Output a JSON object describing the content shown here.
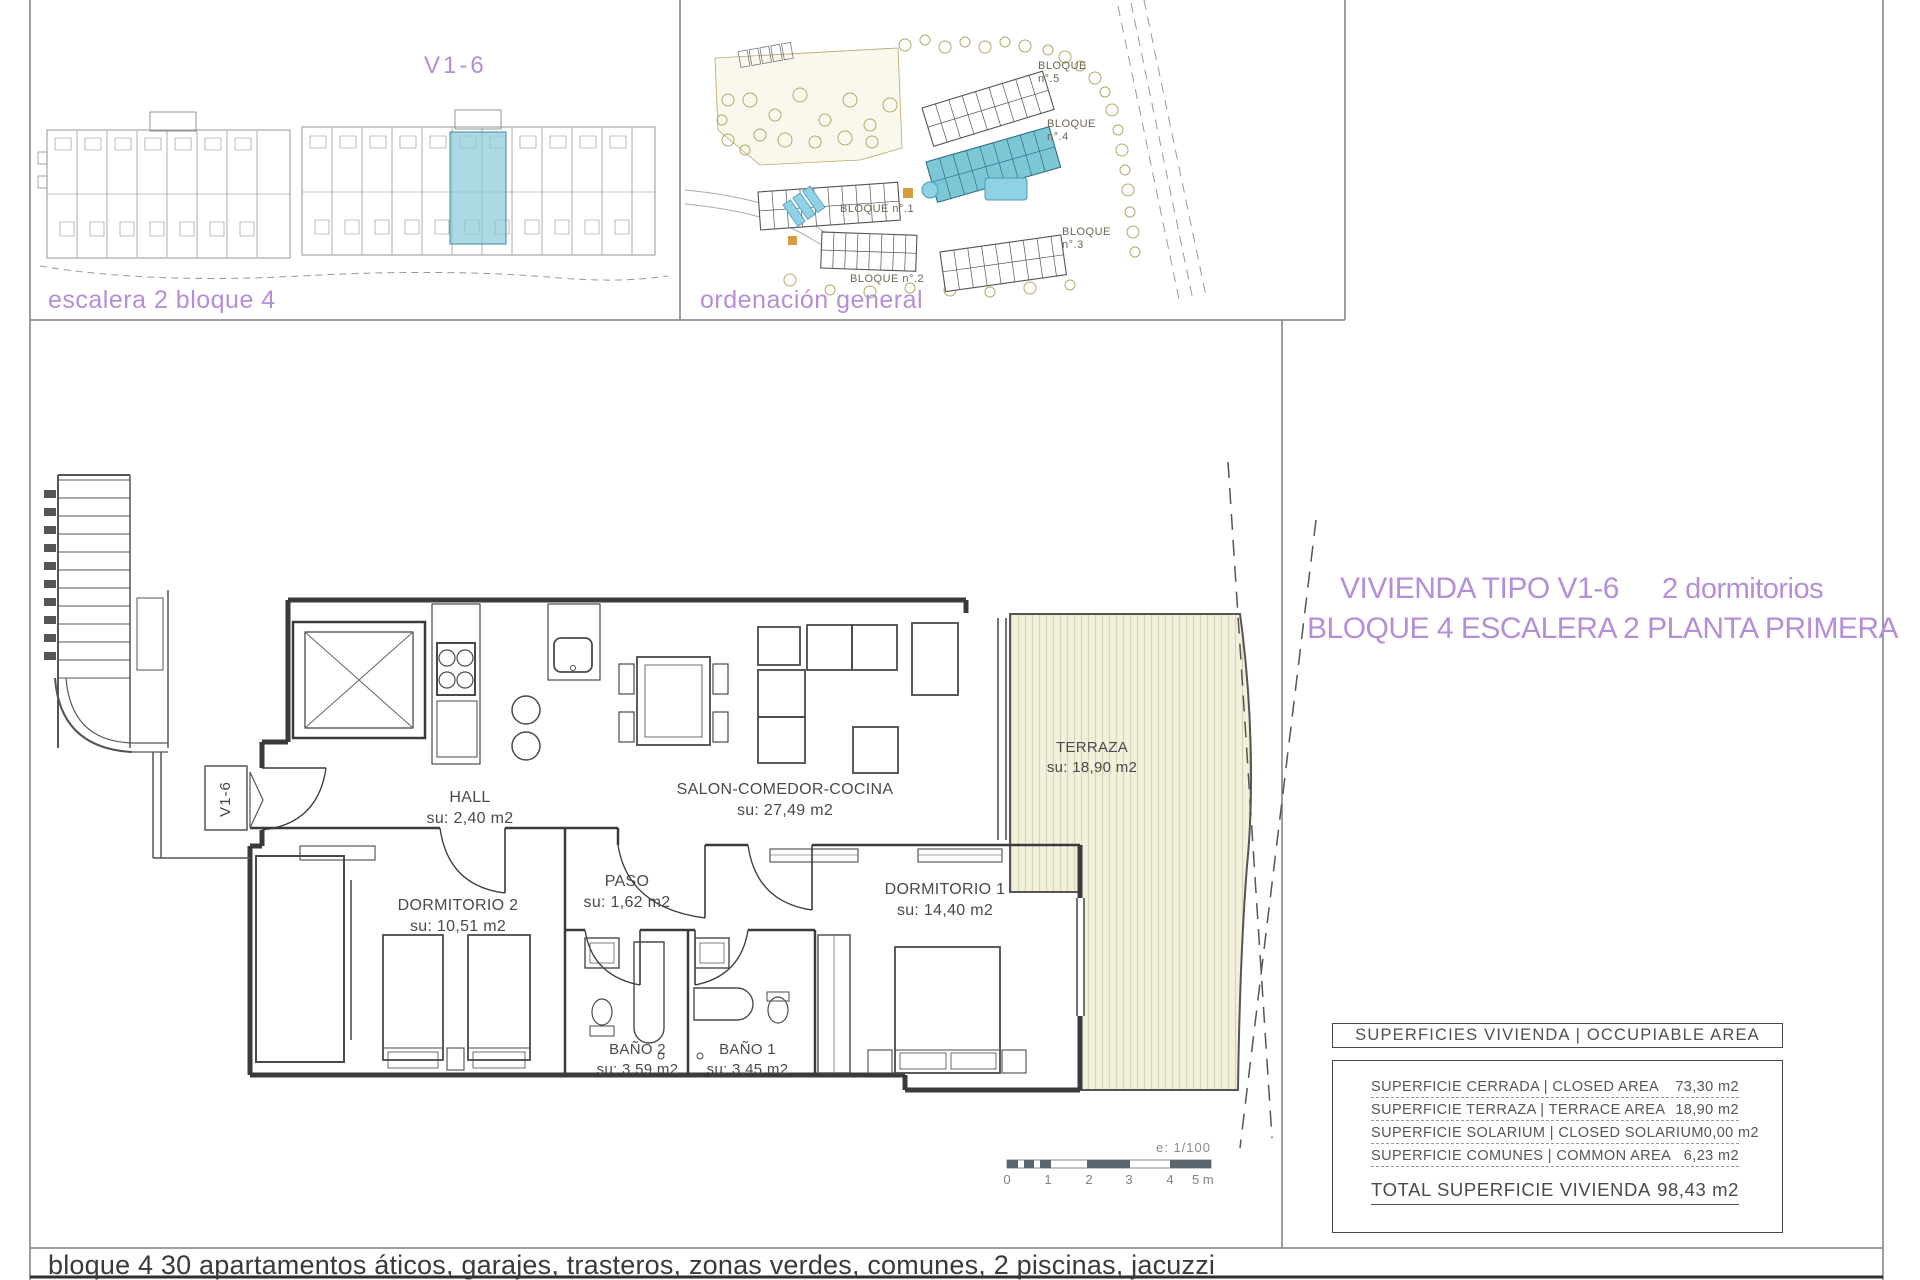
{
  "page": {
    "footer": "bloque 4 30 apartamentos áticos, garajes, trasteros, zonas verdes, comunes, 2 piscinas, jacuzzi"
  },
  "colors": {
    "accent_purple": "#b48fd8",
    "highlight_teal": "#8bccd9",
    "terrace_cream": "#f3f0dc"
  },
  "panel_building": {
    "unit_label": "V1-6",
    "caption": "escalera 2 bloque 4"
  },
  "panel_siteplan": {
    "caption": "ordenación general",
    "block_labels": [
      "BLOQUE n°.5",
      "BLOQUE n°.4",
      "BLOQUE n°.3",
      "BLOQUE n°.2",
      "BLOQUE n°.1"
    ]
  },
  "title": {
    "line1": "VIVIENDA TIPO V1-6",
    "line1_right": "2 dormitorios",
    "line2": "BLOQUE 4  ESCALERA 2  PLANTA PRIMERA"
  },
  "floorplan": {
    "marker": "V1-6",
    "rooms": [
      {
        "id": "hall",
        "name": "HALL",
        "area": "su: 2,40 m2"
      },
      {
        "id": "salon",
        "name": "SALON-COMEDOR-COCINA",
        "area": "su: 27,49 m2"
      },
      {
        "id": "paso",
        "name": "PASO",
        "area": "su: 1,62 m2"
      },
      {
        "id": "dormitorio2",
        "name": "DORMITORIO 2",
        "area": "su: 10,51 m2"
      },
      {
        "id": "dormitorio1",
        "name": "DORMITORIO 1",
        "area": "su: 14,40 m2"
      },
      {
        "id": "bano2",
        "name": "BAÑO 2",
        "area": "su: 3,59 m2"
      },
      {
        "id": "bano1",
        "name": "BAÑO 1",
        "area": "su: 3,45 m2"
      },
      {
        "id": "terraza",
        "name": "TERRAZA",
        "area": "su: 18,90 m2"
      }
    ],
    "scale": {
      "ratio_label": "e: 1/100",
      "ticks": [
        "0",
        "1",
        "2",
        "3",
        "4",
        "5 m"
      ]
    }
  },
  "areas_table": {
    "header": "SUPERFICIES VIVIENDA | OCCUPIABLE AREA",
    "rows": [
      {
        "label": "SUPERFICIE CERRADA | CLOSED AREA",
        "value": "73,30 m2"
      },
      {
        "label": "SUPERFICIE TERRAZA | TERRACE AREA",
        "value": "18,90 m2"
      },
      {
        "label": "SUPERFICIE SOLARIUM | CLOSED SOLARIUM",
        "value": "0,00 m2"
      },
      {
        "label": "SUPERFICIE COMUNES | COMMON AREA",
        "value": "6,23 m2"
      }
    ],
    "total": {
      "label": "TOTAL SUPERFICIE VIVIENDA",
      "value": "98,43 m2"
    }
  }
}
